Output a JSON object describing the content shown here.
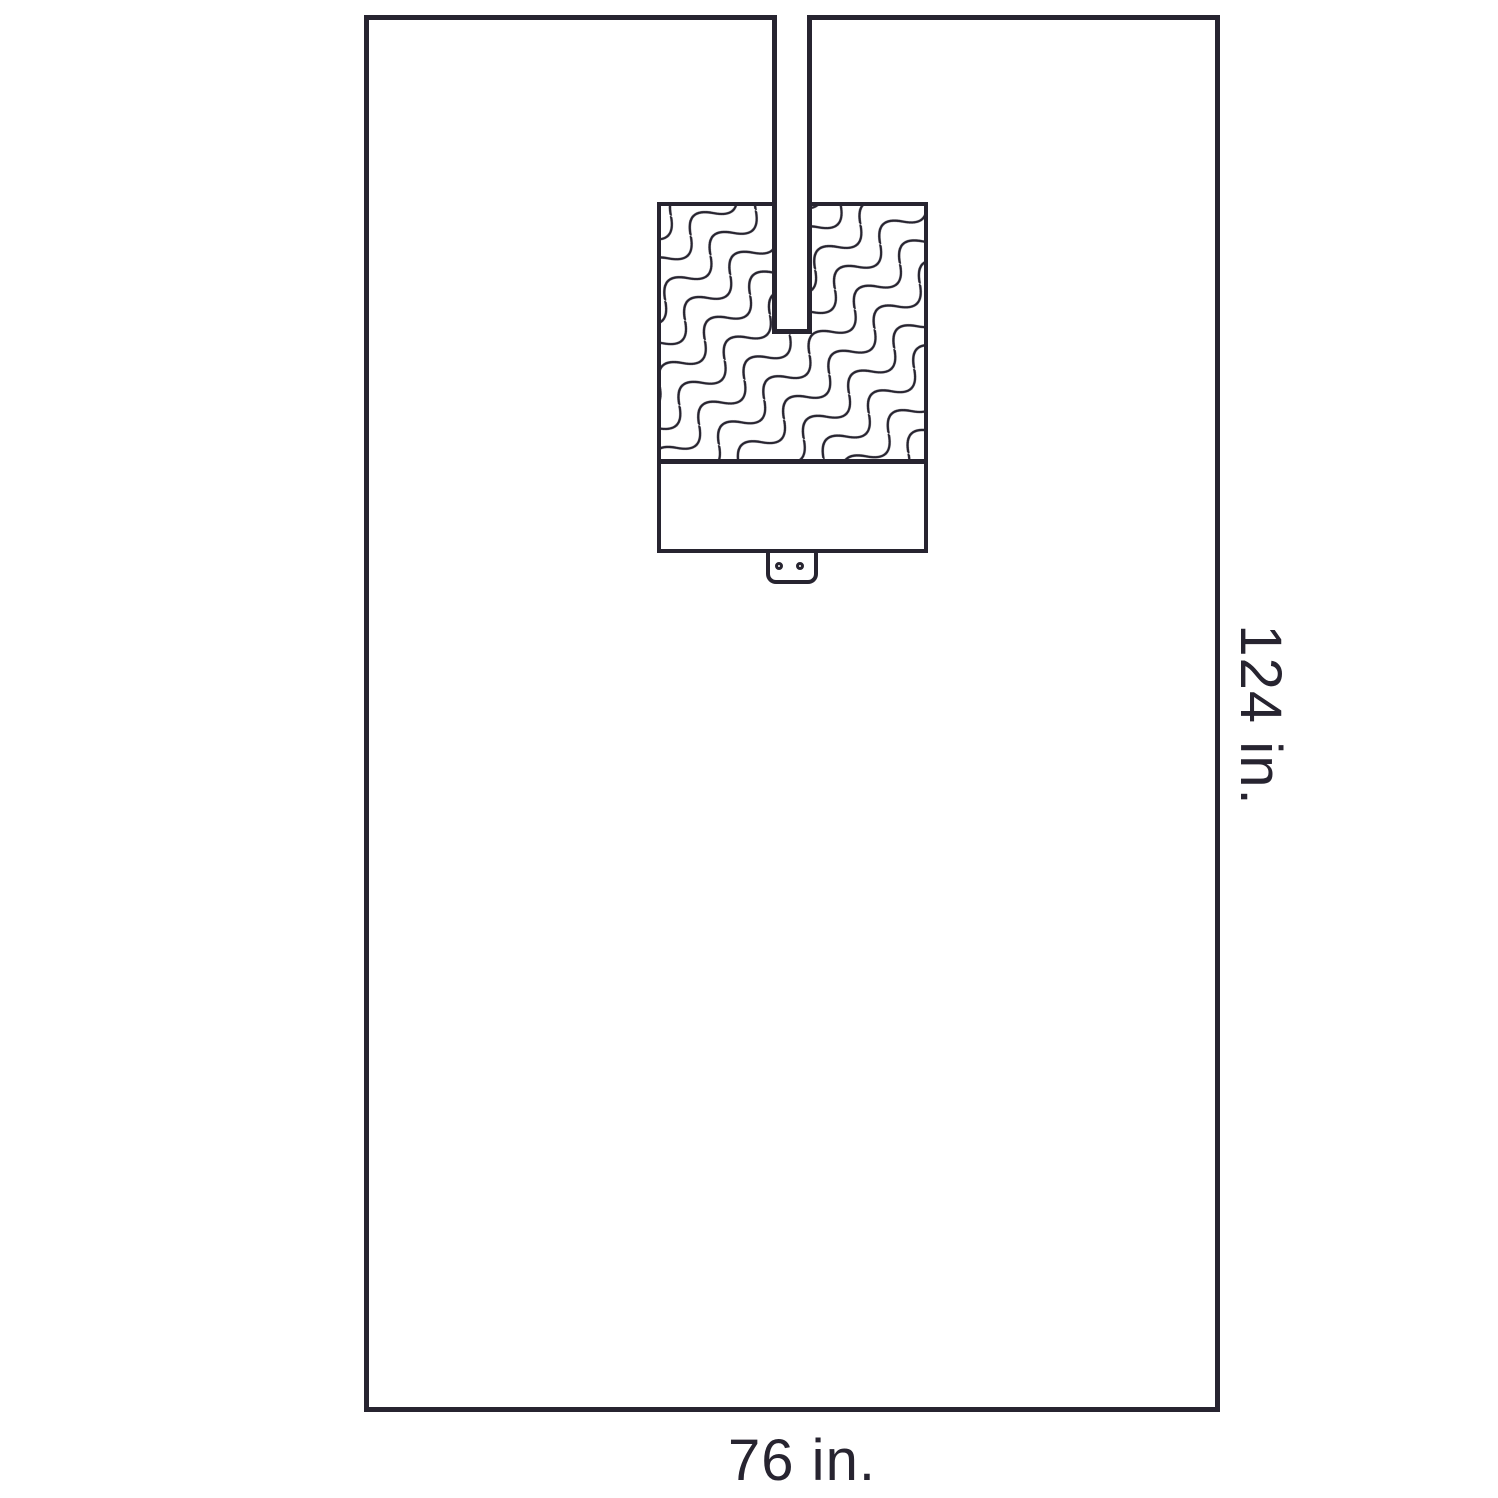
{
  "diagram": {
    "labels": {
      "height": "124 in.",
      "width": "76 in."
    },
    "colors": {
      "line": "#272430",
      "background": "#ffffff"
    },
    "pattern": "diagonal-wavy-lines"
  }
}
